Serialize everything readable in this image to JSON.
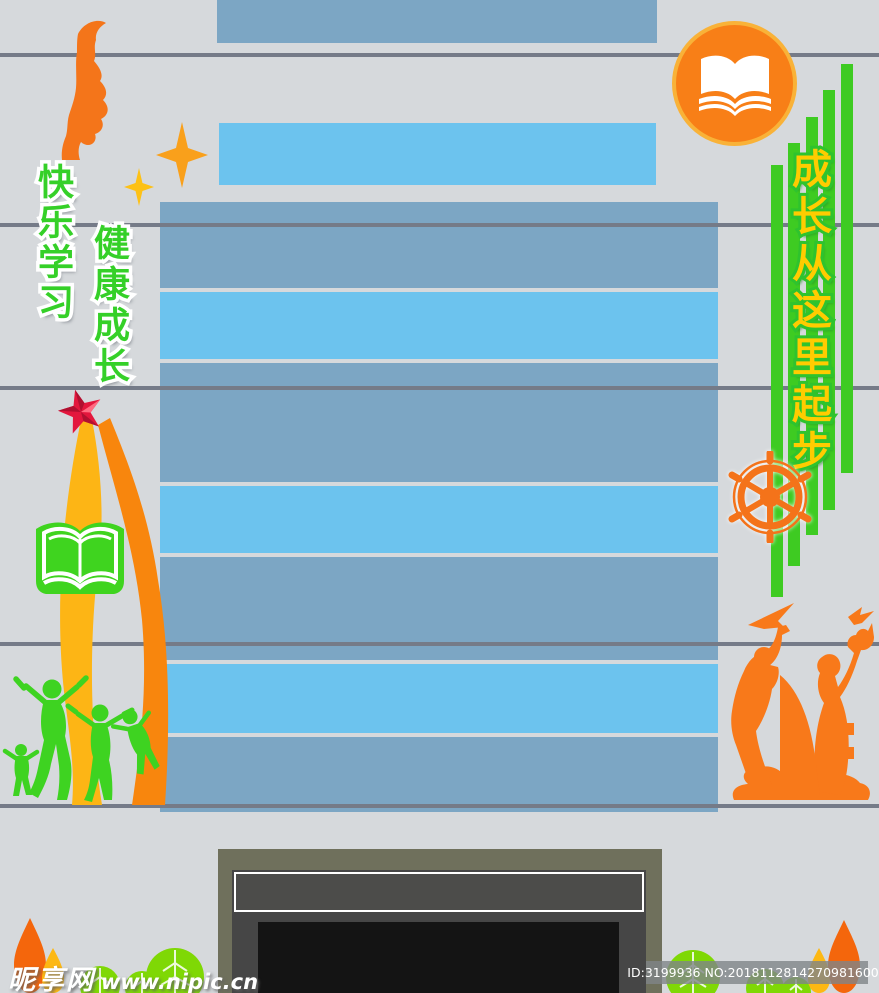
{
  "canvas": {
    "width": 879,
    "height": 993,
    "background": "#d6d9dc"
  },
  "slogans": {
    "left_primary": {
      "text": "快乐学习",
      "fill": "#35d028",
      "outline": "#ffffff"
    },
    "left_secondary": {
      "text": "健康成长",
      "fill": "#35d028",
      "outline": "#ffffff"
    },
    "right": {
      "text": "成长从这里起步",
      "fill": "#ffcc00",
      "outline": "#2ec32e"
    }
  },
  "watermark": {
    "site_name": "昵享网",
    "site_url": "www.nipic.cn"
  },
  "id_bar": {
    "text": "ID:3199936 NO:20181128142709816000"
  },
  "colors": {
    "background": "#d6d9dc",
    "seam_line": "#757b88",
    "panel_muted_blue": "#7ca6c4",
    "panel_bright_blue": "#6cc3ee",
    "accent_orange": "#f8791a",
    "accent_green": "#3ed321",
    "leaf_green": "#7fd805",
    "ribbon_yellow": "#fdb515",
    "ribbon_orange": "#f8860d",
    "star_red": "#e3173d",
    "gold_text": "#ffcc00",
    "badge_ring": "#f9b238",
    "frame_olive": "#6f705c",
    "frame_dark": "#464646",
    "screen_black": "#141414"
  },
  "icons": {
    "top_left": "face-profile-icon",
    "sparkles": "sparkle-star-icon",
    "badge": "open-book-icon",
    "left_book": "open-book-icon",
    "right_wheel": "ship-wheel-icon",
    "left_star": "red-star-icon",
    "children": "jumping-children-icon",
    "statue": "statue-silhouette-icon",
    "trees": "tree-icon"
  },
  "decor": {
    "green_bar_count": 5,
    "blue_stripe_count": 7,
    "seam_line_count": 5
  }
}
